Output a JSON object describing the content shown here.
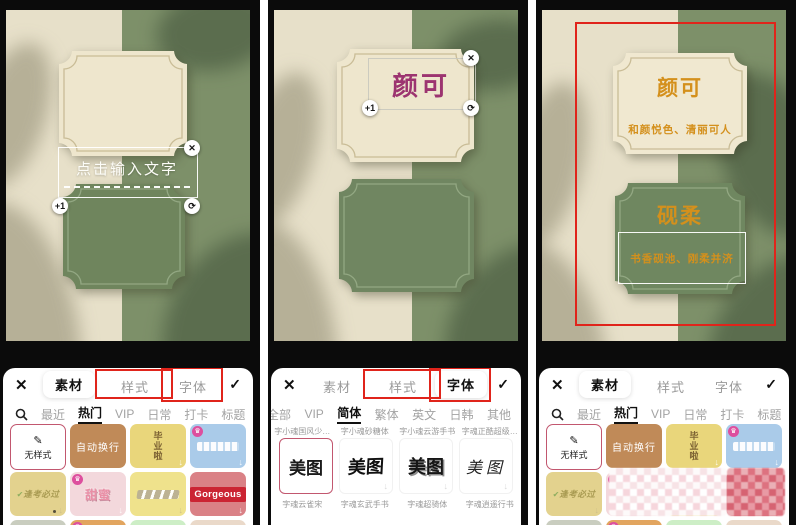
{
  "colors": {
    "annotation_red": "#e0241b",
    "canvas_beige": "#e7e0c9",
    "canvas_green": "#7d9069",
    "card_beige": "#eee6cd",
    "card_green": "#6f855d",
    "accent_pink": "#c2576f",
    "text_magenta": "#9c3470",
    "text_orange": "#d4901c"
  },
  "icons": {
    "close": "✕",
    "check": "✓",
    "rotate": "⟳",
    "plus_one": "+1",
    "crown": "♛",
    "download": "↓",
    "pencil": "✎",
    "sticker_check": "✔"
  },
  "canvas": {
    "placeholder": "点击输入文字",
    "panel2_text": "颜可",
    "panel3": {
      "card1_title": "颜可",
      "card1_subtitle": "和颜悦色、清丽可人",
      "card2_title": "砚柔",
      "card2_subtitle": "书香砚池、刚柔并济"
    }
  },
  "sheet": {
    "tabs": [
      "素材",
      "样式",
      "字体"
    ],
    "sticker_categories": [
      "最近",
      "热门",
      "VIP",
      "日常",
      "打卡",
      "标题"
    ],
    "font_categories": [
      "全部",
      "VIP",
      "简体",
      "繁体",
      "英文",
      "日韩",
      "其他"
    ],
    "stickers": {
      "no_style": "无样式",
      "auto_wrap": "自动换行",
      "graduation": "毕业啦",
      "pass_exam": "逢考必过",
      "sweet": "甜蜜",
      "gorgeous": "Gorgeous"
    },
    "fonts": {
      "sample": "美图",
      "top_labels": [
        "字小魂国风少…",
        "字小魂砂糖体",
        "字小魂云游手书",
        "字魂正酷超级…"
      ],
      "bottom_labels": [
        "字魂云雀宋",
        "字魂玄武手书",
        "字魂超骑体",
        "字魂逍遥行书"
      ]
    }
  }
}
